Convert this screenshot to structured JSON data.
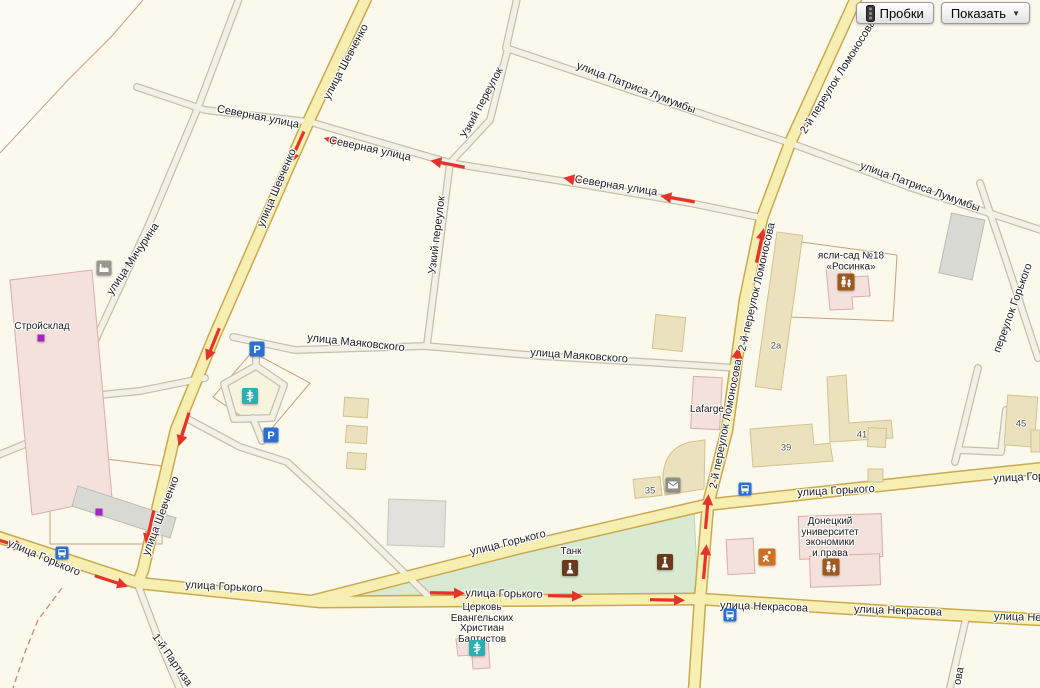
{
  "controls": {
    "traffic_label": "Пробки",
    "show_label": "Показать",
    "show_caret": "▼"
  },
  "colors": {
    "bg": "#fbf8ec",
    "field": "#fdfcf4",
    "road_major_fill": "#f7eeb2",
    "road_major_casing": "#c9a94f",
    "road_minor_fill": "#f3f0e5",
    "road_minor_casing": "#c6c0ab",
    "park_fill": "#d8ead2",
    "park_stroke": "#bdd5b4",
    "bld_beige": "#ebe2bd",
    "bld_beige_stroke": "#d2c290",
    "bld_pink": "#f4e1dc",
    "bld_pink_stroke": "#d9aea6",
    "bld_gray": "#dadad5",
    "bld_gray_stroke": "#bcbcb6",
    "plot_line": "#c7a07e",
    "boundary_dash": "#cc8f7c",
    "arrow_red": "#e5332a",
    "label": "#1e1e1e",
    "house": "#56524a",
    "icon_blue": "#2a6fd4",
    "icon_teal": "#2ab0b0",
    "icon_brown": "#6a3a1c",
    "icon_edu": "#9c5a20",
    "icon_orange": "#cf7122",
    "icon_gray": "#8f8d86",
    "marker_purple": "#a524c4",
    "btn_border": "#999999"
  },
  "streets": [
    {
      "t": "улица Патриса Лумумбы",
      "x": 636,
      "y": 88,
      "r": 21
    },
    {
      "t": "улица Патриса Лумумбы",
      "x": 920,
      "y": 187,
      "r": 20
    },
    {
      "t": "улица Шевченко",
      "x": 346,
      "y": 62,
      "r": -62
    },
    {
      "t": "улица Шевченко",
      "x": 277,
      "y": 188,
      "r": -67
    },
    {
      "t": "улица Шевченко",
      "x": 161,
      "y": 516,
      "r": -69
    },
    {
      "t": "Северная улица",
      "x": 258,
      "y": 117,
      "r": 11
    },
    {
      "t": "Северная улица",
      "x": 370,
      "y": 149,
      "r": 12
    },
    {
      "t": "Северная улица",
      "x": 616,
      "y": 186,
      "r": 9
    },
    {
      "t": "Узкий переулок",
      "x": 482,
      "y": 103,
      "r": -62
    },
    {
      "t": "Узкий переулок",
      "x": 437,
      "y": 235,
      "r": -83
    },
    {
      "t": "улица Мичурина",
      "x": 133,
      "y": 259,
      "r": -56
    },
    {
      "t": "улица Маяковского",
      "x": 356,
      "y": 343,
      "r": 6
    },
    {
      "t": "улица Маяковского",
      "x": 579,
      "y": 356,
      "r": 4
    },
    {
      "t": "2-й переулок Ломоносова",
      "x": 838,
      "y": 77,
      "r": -58
    },
    {
      "t": "2-й переулок Ломоносова",
      "x": 757,
      "y": 287,
      "r": -77
    },
    {
      "t": "2-й переулок Ломоносова",
      "x": 726,
      "y": 424,
      "r": -79
    },
    {
      "t": "переулок Горького",
      "x": 1013,
      "y": 308,
      "r": -70
    },
    {
      "t": "улица Горького",
      "x": 44,
      "y": 558,
      "r": 23
    },
    {
      "t": "улица Горького",
      "x": 224,
      "y": 587,
      "r": 3
    },
    {
      "t": "улица Горького",
      "x": 508,
      "y": 543,
      "r": -14
    },
    {
      "t": "улица Горького",
      "x": 504,
      "y": 594,
      "r": 1
    },
    {
      "t": "улица Горького",
      "x": 836,
      "y": 491,
      "r": -3
    },
    {
      "t": "улица Горького",
      "x": 1032,
      "y": 477,
      "r": -3
    },
    {
      "t": "улица Некрасова",
      "x": 764,
      "y": 607,
      "r": 2
    },
    {
      "t": "улица Некрасова",
      "x": 898,
      "y": 611,
      "r": 2
    },
    {
      "t": "улица Некрасова",
      "x": 1038,
      "y": 618,
      "r": 2
    },
    {
      "t": "1-й Партиза",
      "x": 172,
      "y": 660,
      "r": 55
    },
    {
      "t": "ова",
      "x": 959,
      "y": 676,
      "r": -80
    }
  ],
  "pois": [
    {
      "lines": [
        "Стройсклад"
      ],
      "x": 42,
      "y": 327
    },
    {
      "lines": [
        "ясли-сад №18",
        "«Росинка»"
      ],
      "x": 851,
      "y": 262
    },
    {
      "lines": [
        "Lafarge"
      ],
      "x": 707,
      "y": 410
    },
    {
      "lines": [
        "Донецкий",
        "университет",
        "экономики",
        "и права"
      ],
      "x": 830,
      "y": 538
    },
    {
      "lines": [
        "Церковь",
        "Евангельских",
        "Христиан",
        "Баптистов"
      ],
      "x": 482,
      "y": 624
    },
    {
      "lines": [
        "Танк"
      ],
      "x": 571,
      "y": 552
    }
  ],
  "houses": [
    {
      "t": "2а",
      "x": 776,
      "y": 346
    },
    {
      "t": "39",
      "x": 786,
      "y": 448
    },
    {
      "t": "41",
      "x": 862,
      "y": 435
    },
    {
      "t": "45",
      "x": 1021,
      "y": 424
    },
    {
      "t": "35",
      "x": 650,
      "y": 491
    }
  ],
  "icons": [
    {
      "type": "parking-icon",
      "x": 257,
      "y": 349
    },
    {
      "type": "parking-icon",
      "x": 271,
      "y": 435
    },
    {
      "type": "bus-stop-icon",
      "x": 62,
      "y": 553
    },
    {
      "type": "bus-stop-icon",
      "x": 745,
      "y": 489
    },
    {
      "type": "bus-stop-icon",
      "x": 730,
      "y": 615
    },
    {
      "type": "church-icon",
      "x": 250,
      "y": 396
    },
    {
      "type": "church-icon",
      "x": 477,
      "y": 648
    },
    {
      "type": "monument-icon",
      "x": 570,
      "y": 568
    },
    {
      "type": "monument-icon",
      "x": 665,
      "y": 562
    },
    {
      "type": "post-office-icon",
      "x": 673,
      "y": 485
    },
    {
      "type": "kindergarten-icon",
      "x": 846,
      "y": 282
    },
    {
      "type": "university-icon",
      "x": 831,
      "y": 567
    },
    {
      "type": "sport-icon",
      "x": 767,
      "y": 557
    },
    {
      "type": "industrial-icon",
      "x": 104,
      "y": 268
    },
    {
      "type": "purple-marker-icon",
      "x": 41,
      "y": 338
    },
    {
      "type": "purple-marker-icon",
      "x": 99,
      "y": 512
    }
  ],
  "arrows": [
    {
      "x": 297,
      "y": 147,
      "r": 114
    },
    {
      "x": 213,
      "y": 344,
      "r": 112
    },
    {
      "x": 184,
      "y": 429,
      "r": 107
    },
    {
      "x": 150,
      "y": 527,
      "r": 103
    },
    {
      "x": 341,
      "y": 143,
      "r": 196
    },
    {
      "x": 448,
      "y": 164,
      "r": 191
    },
    {
      "x": 581,
      "y": 181,
      "r": 190
    },
    {
      "x": 678,
      "y": 199,
      "r": 190
    },
    {
      "x": 760,
      "y": 246,
      "r": -78
    },
    {
      "x": 736,
      "y": 365,
      "r": -82
    },
    {
      "x": 707,
      "y": 512,
      "r": -85
    },
    {
      "x": 705,
      "y": 562,
      "r": -85
    },
    {
      "x": 8,
      "y": 543,
      "r": 18
    },
    {
      "x": 111,
      "y": 581,
      "r": 18
    },
    {
      "x": 447,
      "y": 593,
      "r": 1
    },
    {
      "x": 565,
      "y": 596,
      "r": 1
    },
    {
      "x": 667,
      "y": 600,
      "r": 1
    }
  ]
}
